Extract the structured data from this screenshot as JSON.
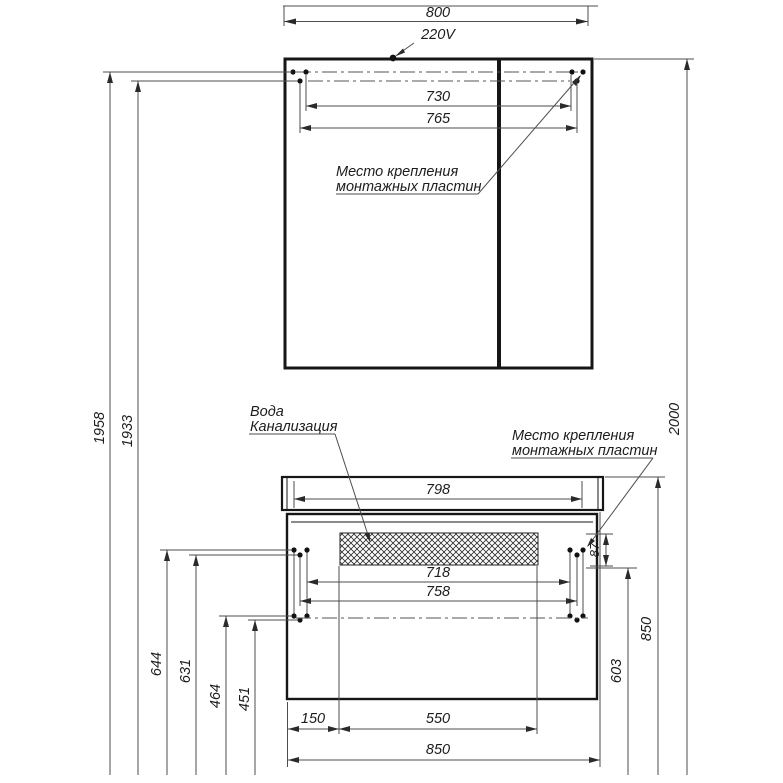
{
  "drawing_title": "Bathroom furniture installation drawing",
  "mirror_cabinet": {
    "width": "800",
    "power": "220V",
    "holes_inner_width": "730",
    "holes_outer_width": "765",
    "note_line1": "Место крепления",
    "note_line2": "монтажных пластин"
  },
  "vanity": {
    "top_width": "798",
    "holes_inner_width": "718",
    "holes_outer_width": "758",
    "plate_height": "87",
    "utility_line1": "Вода",
    "utility_line2": "Канализация",
    "note_line1": "Место крепления",
    "note_line2": "монтажных пластин",
    "drain_offset": "150",
    "drain_zone_width": "550",
    "overall_width": "850"
  },
  "heights": {
    "mirror_upper_mount": "1958",
    "mirror_lower_mount": "1933",
    "overall": "2000",
    "vanity_mount_top_a": "644",
    "vanity_mount_top_b": "631",
    "vanity_mount_bot_a": "464",
    "vanity_mount_bot_b": "451",
    "countertop": "850",
    "mount_line": "603"
  },
  "colors": {
    "line": "#161616",
    "dim_line": "#4d4d4d",
    "text": "#1c1c1c",
    "background": "#ffffff"
  }
}
